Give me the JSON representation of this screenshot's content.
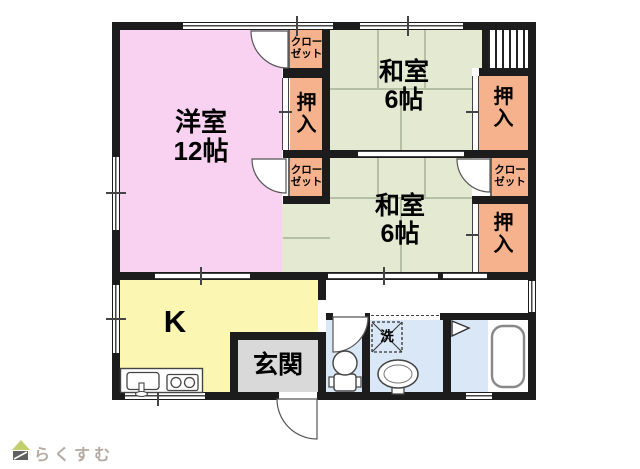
{
  "branding": {
    "logo_text": "らくすむ"
  },
  "rooms": {
    "western_room": {
      "label": "洋室\n12帖"
    },
    "japanese_room_1": {
      "label": "和室\n6帖"
    },
    "japanese_room_2": {
      "label": "和室\n6帖"
    },
    "kitchen": {
      "label": "K"
    },
    "entrance": {
      "label": "玄関"
    },
    "washroom": {
      "washer_label": "洗"
    }
  },
  "storage": {
    "closet_top": {
      "label": "クローゼット"
    },
    "closet_mid": {
      "label": "クローゼット"
    },
    "closet_right": {
      "label": "クローゼット"
    },
    "oshiire_mid": {
      "label": "押入"
    },
    "oshiire_top_right": {
      "label": "押入"
    },
    "oshiire_bottom_right": {
      "label": "押入"
    }
  },
  "colors": {
    "wall": "#1c1c1c",
    "western-room": "#f9d2f2",
    "japanese-room": "#e4ead2",
    "storage": "#f6b28c",
    "kitchen": "#fbf7b2",
    "wet-room": "#d9e7f6",
    "entrance": "#d9d9d9",
    "tatami-line": "#b4bfa4",
    "logo-green": "#c3cf6d",
    "logo-dark": "#606060",
    "logo-text": "#b5aaa1"
  }
}
